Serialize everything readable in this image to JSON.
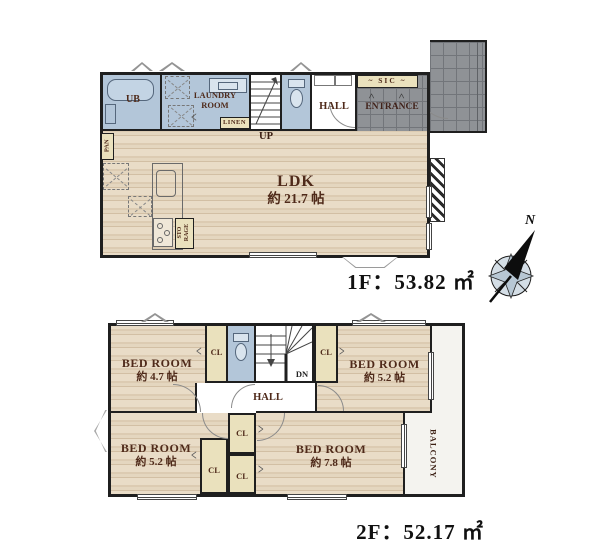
{
  "floor1": {
    "area_label": "1F：53.82 ㎡",
    "compass_label": "N",
    "labels": {
      "ub": "UB",
      "laundry": "LAUNDRY\nROOM",
      "linen": "LINEN",
      "up": "UP",
      "hall": "HALL",
      "sic": "~ SIC ~",
      "entrance": "ENTRANCE",
      "pan": "PAN",
      "storage": "STO\nRAGE",
      "ldk_name": "LDK",
      "ldk_size": "約 21.7 帖"
    }
  },
  "floor2": {
    "area_label": "2F：52.17 ㎡",
    "labels": {
      "bed1_name": "BED ROOM",
      "bed1_size": "約 4.7 帖",
      "bed2_name": "BED ROOM",
      "bed2_size": "約 5.2 帖",
      "bed3_name": "BED ROOM",
      "bed3_size": "約 5.2 帖",
      "bed4_name": "BED ROOM",
      "bed4_size": "約 7.8 帖",
      "cl": "CL",
      "dn": "DN",
      "hall": "HALL",
      "balcony": "BALCONY"
    }
  },
  "colors": {
    "wood": "#e4d6bf",
    "wet_blue": "#b3c6d9",
    "closet_beige": "#eae1bd",
    "tile_gray": "#8f9296",
    "balcony_white": "#f4f3ef",
    "wall": "#1f1f1f",
    "label_brown": "#4f2a1a"
  }
}
